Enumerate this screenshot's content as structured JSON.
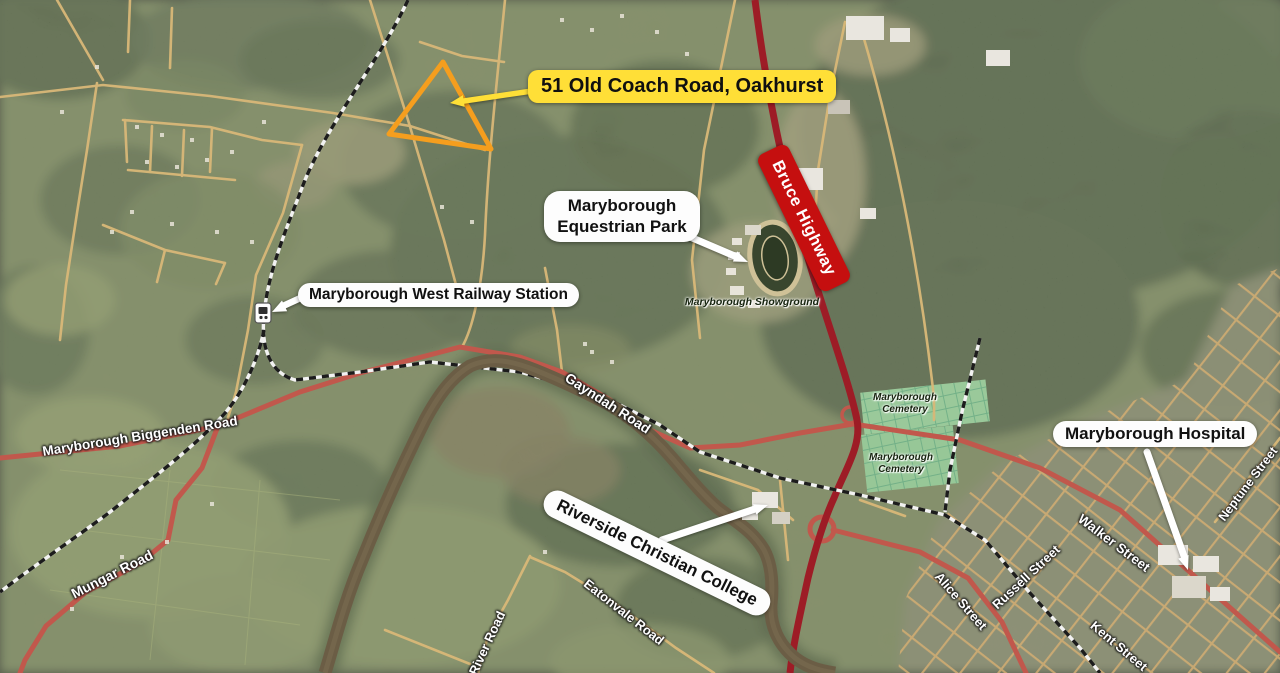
{
  "title": "Annotated satellite location map",
  "property": {
    "label": "51 Old Coach Road, Oakhurst",
    "label_bg": "#ffdf37",
    "boundary_color": "#f59e1e"
  },
  "highway": {
    "label": "Bruce Highway",
    "badge_bg": "#c50f0f",
    "badge_text_color": "#ffffff",
    "line_color": "#9d1c26"
  },
  "pois": {
    "equestrian_park": {
      "label": "Maryborough Equestrian Park"
    },
    "railway_station": {
      "label": "Maryborough West Railway Station"
    },
    "hospital": {
      "label": "Maryborough Hospital"
    },
    "college": {
      "label": "Riverside Christian College"
    }
  },
  "ground_labels": {
    "showground": {
      "label": "Maryborough Showground"
    },
    "cemetery_north": {
      "label": "Maryborough Cemetery"
    },
    "cemetery_south": {
      "label": "Maryborough Cemetery"
    }
  },
  "roads": [
    {
      "id": "maryborough-biggenden-road",
      "label": "Maryborough Biggenden Road"
    },
    {
      "id": "mungar-road",
      "label": "Mungar Road"
    },
    {
      "id": "gayndah-road",
      "label": "Gayndah Road"
    },
    {
      "id": "river-road",
      "label": "River Road"
    },
    {
      "id": "eatonvale-road",
      "label": "Eatonvale Road"
    },
    {
      "id": "alice-street",
      "label": "Alice Street"
    },
    {
      "id": "russell-street",
      "label": "Russell Street"
    },
    {
      "id": "walker-street",
      "label": "Walker Street"
    },
    {
      "id": "kent-street",
      "label": "Kent Street"
    },
    {
      "id": "neptune-street",
      "label": "Neptune Street"
    }
  ],
  "colors": {
    "minor_road": "#d9b878",
    "major_road": "#c1584c",
    "river": "#6b5d45",
    "forest": "#44523a",
    "cemetery_green": "#9ed0a0",
    "callout_bg": "#fdfdfd"
  }
}
